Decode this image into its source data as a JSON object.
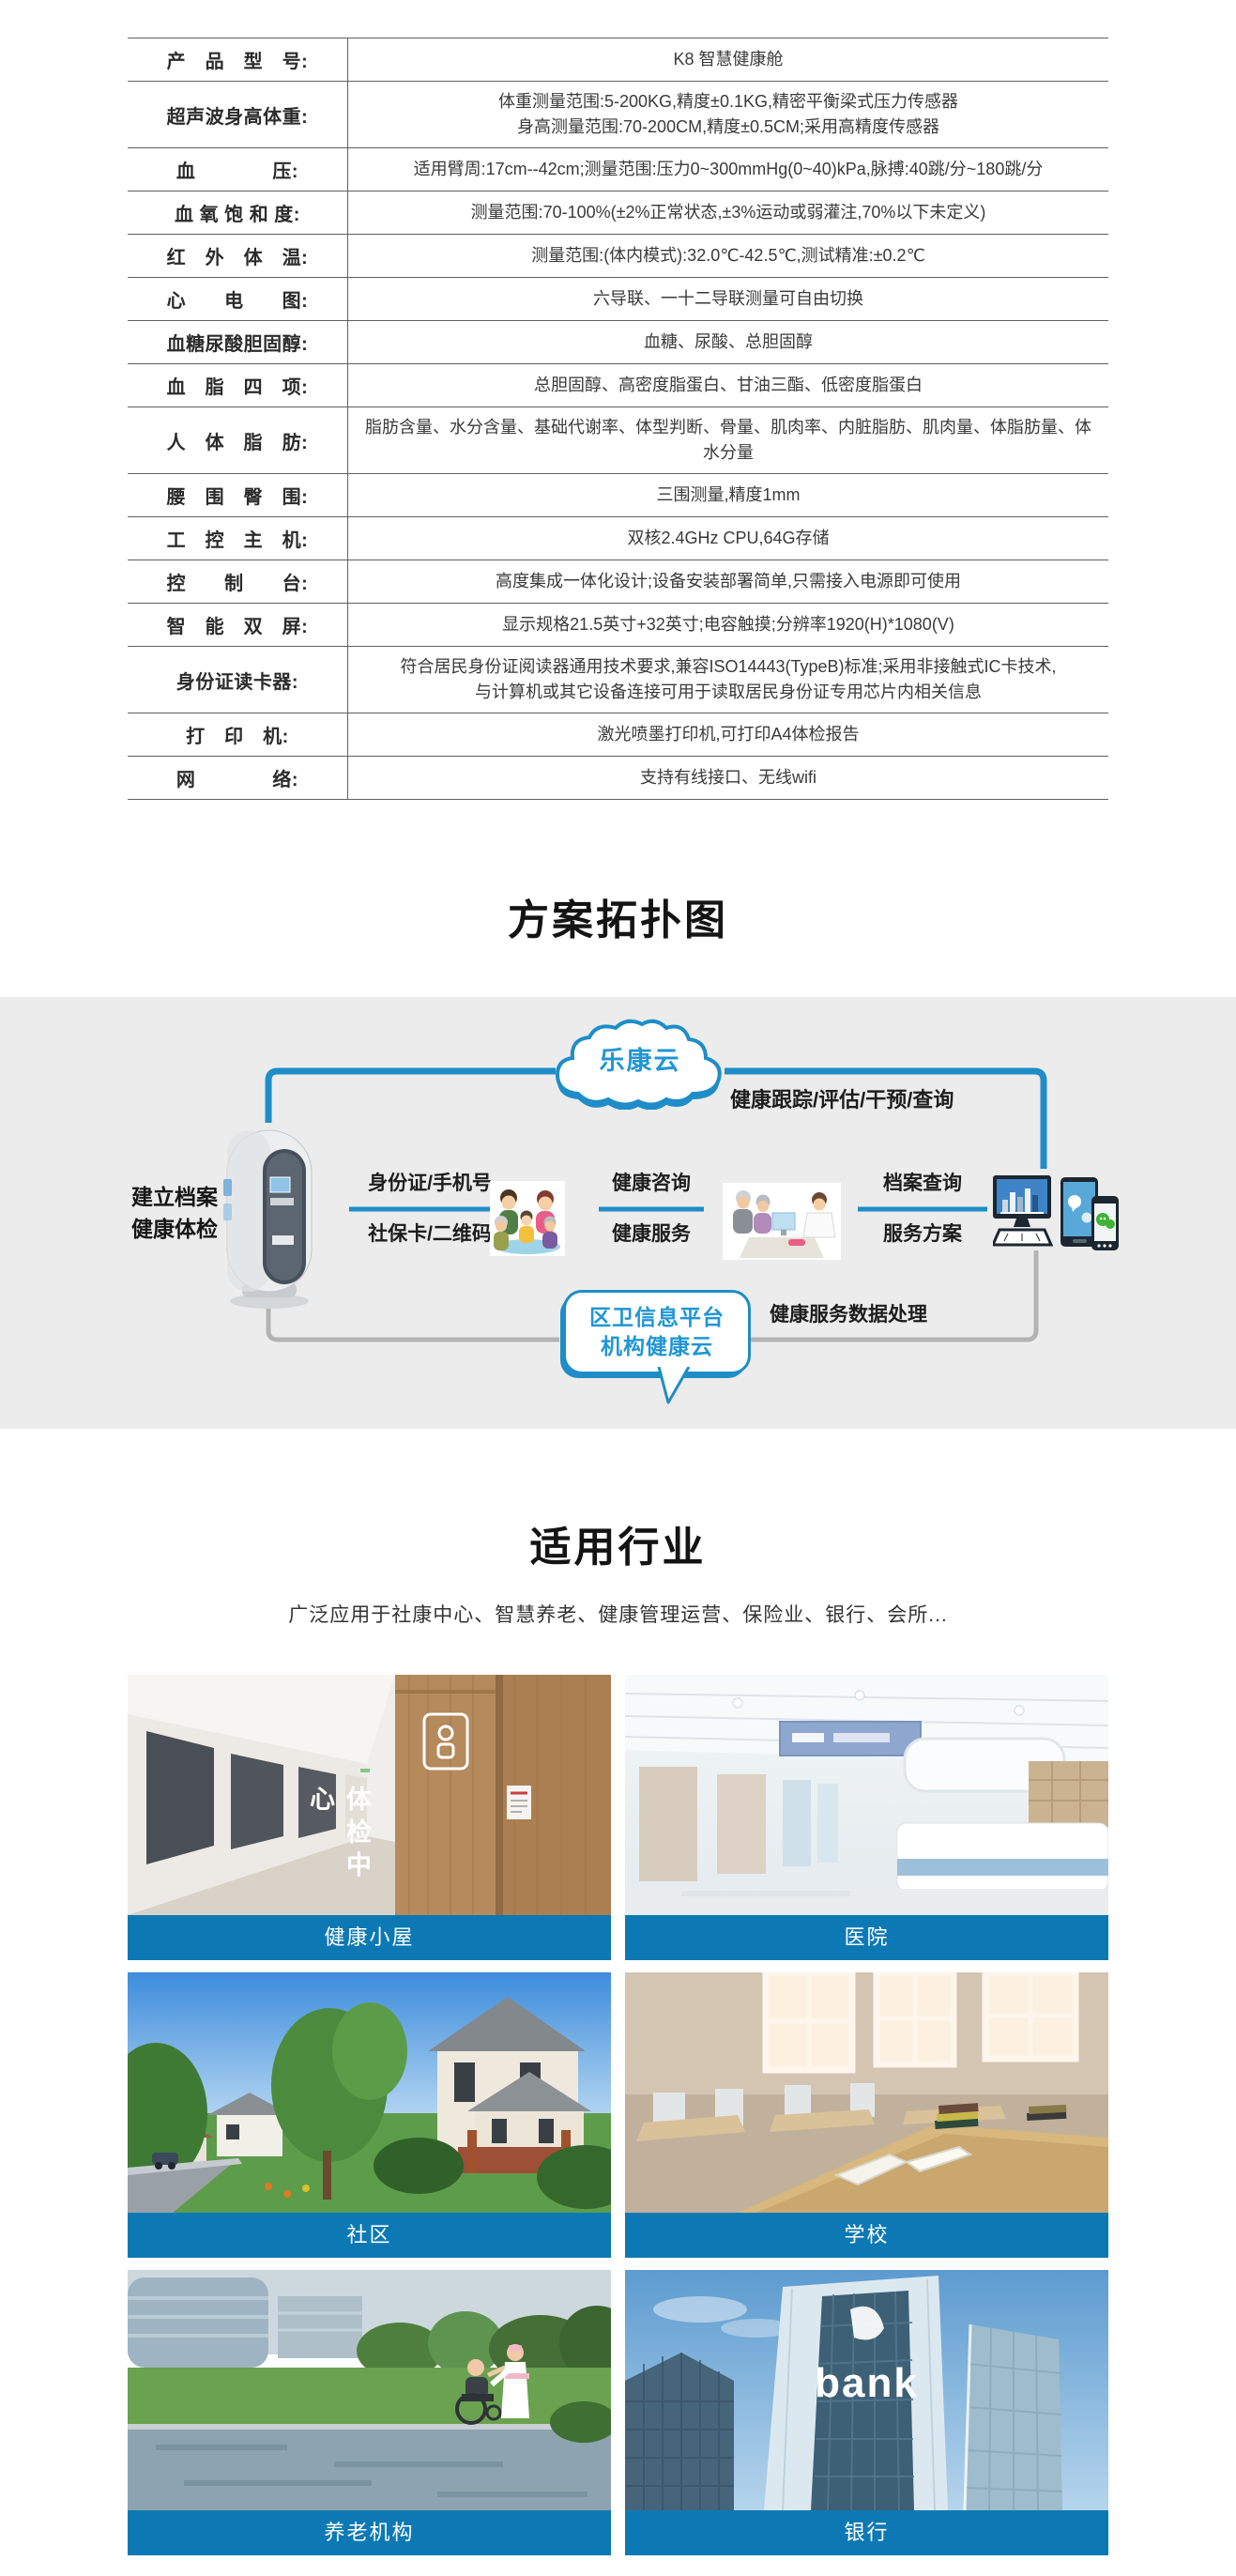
{
  "colors": {
    "accent_blue": "#0d79b4",
    "wire_blue": "#1e8dc8",
    "band_gray": "#ececec",
    "table_line": "#606060"
  },
  "spec_table": {
    "rows": [
      {
        "label": "产　品　型　号:",
        "value": "K8 智慧健康舱"
      },
      {
        "label": "超声波身高体重:",
        "value": "体重测量范围:5-200KG,精度±0.1KG,精密平衡梁式压力传感器\n身高测量范围:70-200CM,精度±0.5CM;采用高精度传感器"
      },
      {
        "label": "血　　　　压:",
        "value": "适用臂周:17cm--42cm;测量范围:压力0~300mmHg(0~40)kPa,脉搏:40跳/分~180跳/分"
      },
      {
        "label": "血 氧 饱 和 度:",
        "value": "测量范围:70-100%(±2%正常状态,±3%运动或弱灌注,70%以下未定义)"
      },
      {
        "label": "红　外　体　温:",
        "value": "测量范围:(体内模式):32.0℃-42.5℃,测试精准:±0.2℃"
      },
      {
        "label": "心　　电　　图:",
        "value": "六导联、一十二导联测量可自由切换"
      },
      {
        "label": "血糖尿酸胆固醇:",
        "value": "血糖、尿酸、总胆固醇"
      },
      {
        "label": "血　脂　四　项:",
        "value": "总胆固醇、高密度脂蛋白、甘油三酯、低密度脂蛋白"
      },
      {
        "label": "人　体　脂　肪:",
        "value": "脂肪含量、水分含量、基础代谢率、体型判断、骨量、肌肉率、内脏脂肪、肌肉量、体脂肪量、体水分量"
      },
      {
        "label": "腰　围　臀　围:",
        "value": "三围测量,精度1mm"
      },
      {
        "label": "工　控　主　机:",
        "value": "双核2.4GHz CPU,64G存储"
      },
      {
        "label": "控　　制　　台:",
        "value": "高度集成一体化设计;设备安装部署简单,只需接入电源即可使用"
      },
      {
        "label": "智　能　双　屏:",
        "value": "显示规格21.5英寸+32英寸;电容触摸;分辨率1920(H)*1080(V)"
      },
      {
        "label": "身份证读卡器:",
        "value": "符合居民身份证阅读器通用技术要求,兼容ISO14443(TypeB)标准;采用非接触式IC卡技术,\n与计算机或其它设备连接可用于读取居民身份证专用芯片内相关信息"
      },
      {
        "label": "打　印　机:",
        "value": "激光喷墨打印机,可打印A4体检报告"
      },
      {
        "label": "网　　　　络:",
        "value": "支持有线接口、无线wifi"
      }
    ]
  },
  "topology": {
    "heading": "方案拓扑图",
    "cloud_label": "乐康云",
    "cloud_caption": "健康跟踪/评估/干预/查询",
    "left_label": "建立档案\n健康体检",
    "pairs": [
      {
        "top": "身份证/手机号",
        "bottom": "社保卡/二维码"
      },
      {
        "top": "健康咨询",
        "bottom": "健康服务"
      },
      {
        "top": "档案查询",
        "bottom": "服务方案"
      }
    ],
    "bubble_label": "区卫信息平台\n机构健康云",
    "data_label": "健康服务数据处理"
  },
  "industries": {
    "heading": "适用行业",
    "subtitle": "广泛应用于社康中心、智慧养老、健康管理运营、保险业、银行、会所...",
    "checkup_sign": "体检中心",
    "bank_sign": "bank",
    "cards": [
      {
        "caption": "健康小屋"
      },
      {
        "caption": "医院"
      },
      {
        "caption": "社区"
      },
      {
        "caption": "学校"
      },
      {
        "caption": "养老机构"
      },
      {
        "caption": "银行"
      }
    ]
  }
}
